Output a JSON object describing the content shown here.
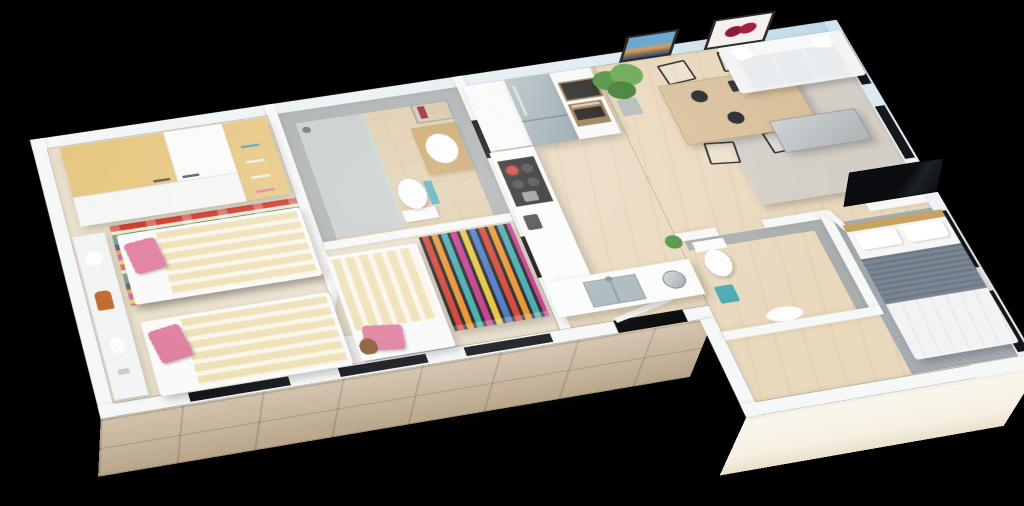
{
  "scene": {
    "description": "3D isometric cutaway floor-plan rendering of a furnished apartment on a black background",
    "background": "#000000"
  },
  "palette": {
    "wall": "#f6f7f7",
    "wall_blue": "#bfd8e8",
    "floor_wood": "#e9d8bc",
    "floor_carpet": "#eadfcb",
    "floor_tile": "#dfcba8",
    "gray_tile": "#a9adad",
    "shower_floor": "#c6cbca",
    "stone": "#c8b396",
    "cream": "#f6efe2",
    "sofa": "#eff1f2",
    "rug_living": "#d3cec6",
    "rug_master": "#a2abb1",
    "table_wood": "#d9c09a",
    "chair": "#2b2b2b",
    "fridge1": "#b7c3c7",
    "fridge2": "#8fa0a7",
    "bronze": "#96764f",
    "appliance_dark": "#22221f",
    "cooktop": "#1c1c1c",
    "burner_red": "#d33427",
    "steel": "#a7b6bc",
    "bed_cream": "#efe0b4",
    "bed_white": "#faf6ea",
    "pink": "#e07e9d",
    "yellow": "#e7c67e",
    "blanket": "#6e7987",
    "duvet": "#f2f3f4",
    "headboard": "#c8a263",
    "teal": "#49a8b4",
    "green": "#4c8f3c",
    "pot": "#b4b8b9",
    "toy_orange": "#bf6a2b",
    "teddy": "#8a5a33",
    "dark": "#15171c",
    "art_blue": "#6fa8cf",
    "art_orange": "#e09a54",
    "onion": "#8e1936",
    "frame": "#2e2a28",
    "krA": "#d2311f",
    "krB": "#f0e9d6",
    "krC": "#3f7d2e",
    "krD": "#2f6cb0",
    "krE": "#1e1e1c",
    "krF": "#e2801f",
    "krG": "#bf2a7a",
    "krH": "#e3bf2a",
    "pcA": "#d23324",
    "pcB": "#e78a1f",
    "pcC": "#35a3a8",
    "pcD": "#c22a84",
    "pcE": "#e5c02c",
    "pcF": "#3a6fc0"
  },
  "rooms": [
    {
      "id": "kids-bedroom",
      "furniture": [
        "wardrobe-yellow-white",
        "twin-bed-striped",
        "twin-bed-striped",
        "multicolor-striped-rug",
        "wall-shelf",
        "lamp",
        "giraffe-toy",
        "pink-pillows"
      ]
    },
    {
      "id": "bathroom",
      "furniture": [
        "walk-in-shower",
        "toilet",
        "washbasin-wood-counter",
        "mirror",
        "teal-towel"
      ]
    },
    {
      "id": "small-bedroom",
      "furniture": [
        "single-bed-striped",
        "pencil-pattern-rug",
        "teddy-bear",
        "pink-pillow"
      ]
    },
    {
      "id": "kitchen",
      "furniture": [
        "tall-cabinet",
        "fridge-freezer-steel",
        "oven-column-bronze",
        "microwave",
        "induction-cooktop",
        "steel-sink",
        "kettle",
        "coffee-machine",
        "counter-plant"
      ]
    },
    {
      "id": "dining-area",
      "furniture": [
        "wood-dining-table",
        "wire-chair",
        "wire-chair",
        "wire-chair",
        "wire-chair",
        "monstera-plant",
        "black-placemats"
      ]
    },
    {
      "id": "living-room",
      "furniture": [
        "white-sofa",
        "coffee-table",
        "flat-tv-leaning",
        "gray-area-rug",
        "seascape-picture",
        "red-onions-picture"
      ]
    },
    {
      "id": "wc",
      "furniture": [
        "toilet",
        "teal-bin",
        "washbasin"
      ]
    },
    {
      "id": "master-bedroom",
      "furniture": [
        "double-bed-gray-blanket",
        "textured-rug",
        "wood-headboard"
      ]
    }
  ],
  "windows": {
    "bottom_wall": 3,
    "right_wall": 4
  },
  "facades": {
    "lower_left": "beige-stone-tiles",
    "lower_right": "cream-plaster",
    "right": "white-with-sky-reflection"
  }
}
